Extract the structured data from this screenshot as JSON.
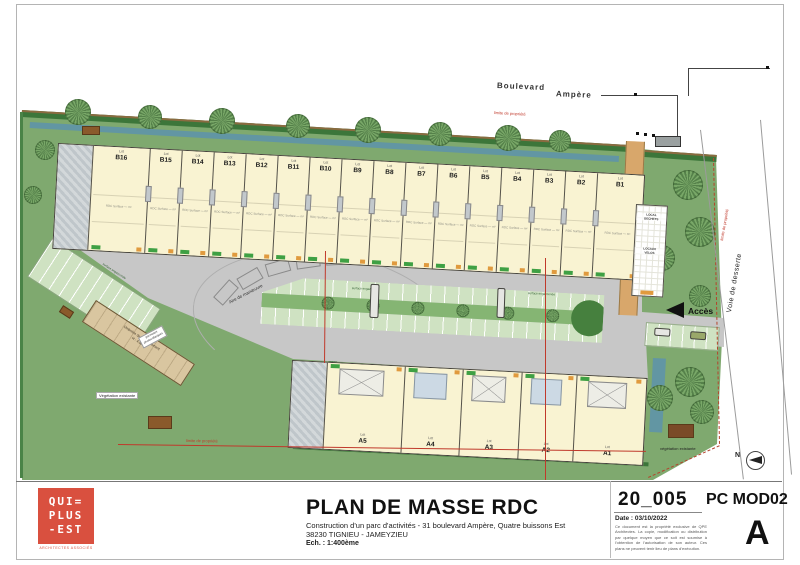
{
  "plan": {
    "street": {
      "word1": "Boulevard",
      "word2": "Ampère"
    },
    "labels": {
      "access": "Accès",
      "service_road": "Voie de desserte",
      "north": "N",
      "maneuver": "Aire de manœuvre",
      "vegetation_1": "Végétation existante",
      "vegetation_2": "végétation existante",
      "property_limit_top": "limite de propriété",
      "property_limit_bottom": "limite de propriété",
      "property_limit_right": "limite de propriété",
      "grass_1": "surface engazonnée",
      "grass_2": "surface engazonnée",
      "grass_3": "surface engazonnée",
      "canopy_line1": "Ombrière de stationnement",
      "canopy_line2": "H : 4,50 m",
      "canopy_note1": "panneaux",
      "canopy_note2": "photovoltaïques",
      "waste_room_line1": "LOCAL",
      "waste_room_line2": "DECHETS",
      "bike_room_line1": "LOCAUX",
      "bike_room_line2": "VELOS"
    },
    "lot_prefix": "Lot",
    "lot_detail": "RDC Surface — m²",
    "lots_b": [
      "B16",
      "B15",
      "B14",
      "B13",
      "B12",
      "B11",
      "B10",
      "B9",
      "B8",
      "B7",
      "B6",
      "B5",
      "B4",
      "B3",
      "B2",
      "B1"
    ],
    "lots_a": [
      "A5",
      "A4",
      "A3",
      "A2",
      "A1"
    ]
  },
  "title_block": {
    "logo": {
      "line1": "QUI=",
      "line2": "PLUS",
      "line3": "-EST",
      "tagline": "ARCHITECTES ASSOCIÉS"
    },
    "title": "PLAN DE MASSE RDC",
    "project_line1": "Construction d'un parc d'activités - 31 boulevard Ampère, Quatre buissons Est",
    "project_line2": "38230 TIGNIEU - JAMEYZIEU",
    "scale": "Ech. : 1:400ème",
    "doc_number": "20_005",
    "doc_code": "PC MOD02",
    "date": "Date : 03/10/2022",
    "disclaimer": "Ce document est la propriété exclusive de QPE Architectes. La copie, modification ou distribution par quelque moyen que ce soit est soumise à l'obtention de l'autorisation de son auteur. Ces plans ne peuvent tenir lieu de plans d'exécution.",
    "revision": "A"
  },
  "colors": {
    "site_green": "#7fa96f",
    "hedge_green": "#3c763a",
    "building_cream": "#f9f3d2",
    "asphalt_grey": "#c7c7c7",
    "road_tan": "#d8a76b",
    "water_blue": "#5f93a8",
    "property_red": "#c0392b",
    "logo_red": "#d9503f"
  }
}
